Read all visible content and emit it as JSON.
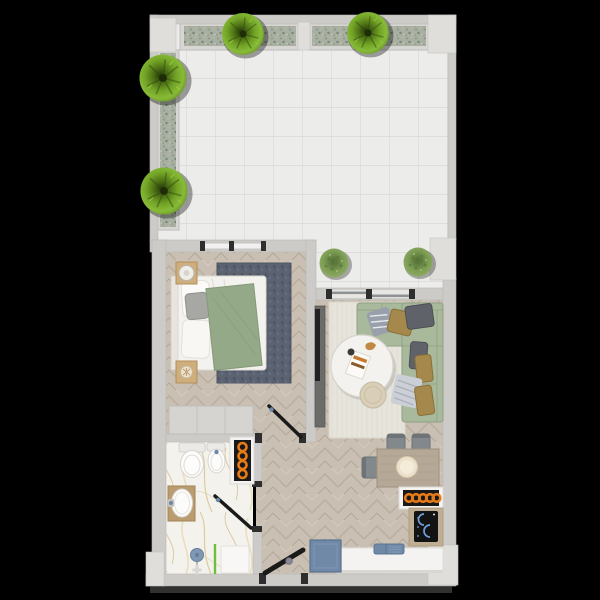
{
  "scene": {
    "type": "apartment-floor-plan-top-down-render",
    "background": "black",
    "rooms": [
      {
        "id": "terrace",
        "features": [
          "white-tile-floor",
          "two-planter-boxes-top-wall",
          "planter-box-left-wall",
          "four-round-trees",
          "two-potted-shrubs-at-living-room-glass-door"
        ]
      },
      {
        "id": "bedroom",
        "features": [
          "double-bed-white-bedding",
          "sage-green-throw",
          "grey-cushion",
          "two-wood-nightstands",
          "sphere-lamp",
          "dark-blue-rug",
          "herringbone-wood-floor",
          "wardrobe",
          "window-to-terrace"
        ]
      },
      {
        "id": "living-room",
        "features": [
          "l-shaped-sage-sofa",
          "seven-cushions",
          "round-white-coffee-table",
          "books",
          "beige-pouf",
          "cream-rug",
          "media-sideboard-with-tv",
          "sliding-glass-door-to-terrace"
        ]
      },
      {
        "id": "kitchen-dining",
        "features": [
          "wood-dining-table",
          "plate",
          "three-grey-chairs",
          "horizontal-radiator",
          "induction-hob",
          "white-counter",
          "blue-sink",
          "blue-appliance-box",
          "entrance-door"
        ]
      },
      {
        "id": "bathroom",
        "features": [
          "marble-floor",
          "toilet",
          "bidet",
          "wood-vanity-basin",
          "vertical-towel-radiator",
          "shower-green-glass-screen",
          "blue-shower-head"
        ]
      }
    ],
    "doors": [
      "bedroom-door",
      "bathroom-door",
      "entrance-door"
    ],
    "windows": [
      "bedroom-window",
      "living-room-sliding-door"
    ]
  },
  "colors": {
    "background": "#000000",
    "wall": "#cdcbc8",
    "wall_light": "#dfdedb",
    "door_frame_dark": "#2e2e2e",
    "door_black": "#1a1a1a",
    "handle_blue": "#6a88a8",
    "terrace_tile": "#ececeb",
    "tree_green": "#7fb02c",
    "shrub_green": "#8fae66",
    "wood_floor": "#c9c0b3",
    "marble_floor": "#f4f2ec",
    "bedroom_rug": "#5b6272",
    "bed_white": "#f4f2ee",
    "blanket_green": "#94a987",
    "pillow_gray": "#a7a7a3",
    "nightstand_wood": "#cfae7e",
    "wardrobe_gray": "#d6d4d1",
    "media_unit_gray": "#6b6b69",
    "tv_black": "#222222",
    "living_rug": "#e7e4dc",
    "sofa_green": "#a9b99c",
    "cushion_dark_gray": "#5f6269",
    "cushion_mustard": "#a5894c",
    "cushion_striped_gray": "#99a0ac",
    "cushion_striped_white": "#ccd0d6",
    "coffee_table_white": "#f4f2ef",
    "ottoman_beige": "#d9ceb7",
    "dining_table_wood": "#b5a896",
    "chair_gray": "#83888d",
    "plate_cream": "#ece1cb",
    "radiator_orange": "#e67a17",
    "radiator_black": "#191919",
    "cooktop_black": "#131313",
    "hob_blue": "#6f9fd8",
    "counter_white": "#f4f3f1",
    "appliance_blue": "#7089a7",
    "fixture_white": "#fcfcfb",
    "vanity_wood": "#bb9c71",
    "shower_glass_green": "#6fbf3f",
    "shower_head_blue": "#8099b3"
  }
}
